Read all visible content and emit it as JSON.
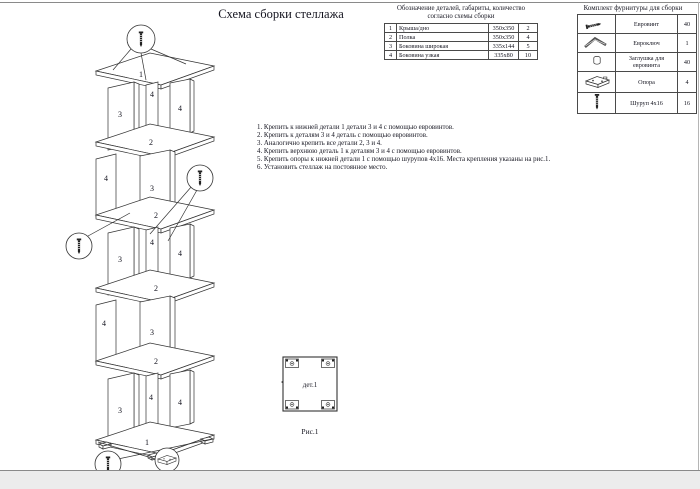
{
  "page": {
    "title": "Схема сборки стеллажа"
  },
  "colors": {
    "ink": "#333333",
    "text": "#151520",
    "page_edge": "#ececec"
  },
  "parts_table": {
    "title_line1": "Обозначение деталей, габариты, количество",
    "title_line2": "согласно схемы сборки",
    "rows": [
      {
        "num": "1",
        "name": "Крыша/дно",
        "size": "350х350",
        "qty": "2"
      },
      {
        "num": "2",
        "name": "Полка",
        "size": "350х350",
        "qty": "4"
      },
      {
        "num": "3",
        "name": "Боковина широкая",
        "size": "335х144",
        "qty": "5"
      },
      {
        "num": "4",
        "name": "Боковина узкая",
        "size": "335х80",
        "qty": "10"
      }
    ]
  },
  "fittings_table": {
    "title": "Комплект фурнитуры для сборки",
    "rows": [
      {
        "icon": "euroscrew-icon",
        "name": "Евровинт",
        "qty": "40"
      },
      {
        "icon": "hexkey-icon",
        "name": "Евроключ",
        "qty": "1"
      },
      {
        "icon": "cap-icon",
        "name": "Заглушка для евровинта",
        "qty": "40"
      },
      {
        "icon": "support-icon",
        "name": "Опора",
        "qty": "4"
      },
      {
        "icon": "screw-icon",
        "name": "Шуруп 4х16",
        "qty": "16"
      }
    ]
  },
  "instructions": {
    "items": [
      "1. Крепить к нижней детали 1 детали 3 и 4 с помощью евровинтов.",
      "2. Крепить к деталям 3 и 4 деталь с помощью евровинтов.",
      "3. Аналогично крепить все детали 2, 3 и 4.",
      "4. Крепить верхнюю деталь 1 к деталям 3 и 4 с помощью евровинтов.",
      "5. Крепить опоры к нижней детали 1 с помощью шурупов 4х16. Места крепления указаны на рис.1.",
      "6. Установить стеллаж на постоянное место."
    ]
  },
  "figure": {
    "label": "дет.1",
    "caption": "Рис.1"
  },
  "diagram": {
    "part_top_bottom": "1",
    "part_shelf": "2",
    "part_side_wide": "3",
    "part_side_narrow": "4"
  }
}
